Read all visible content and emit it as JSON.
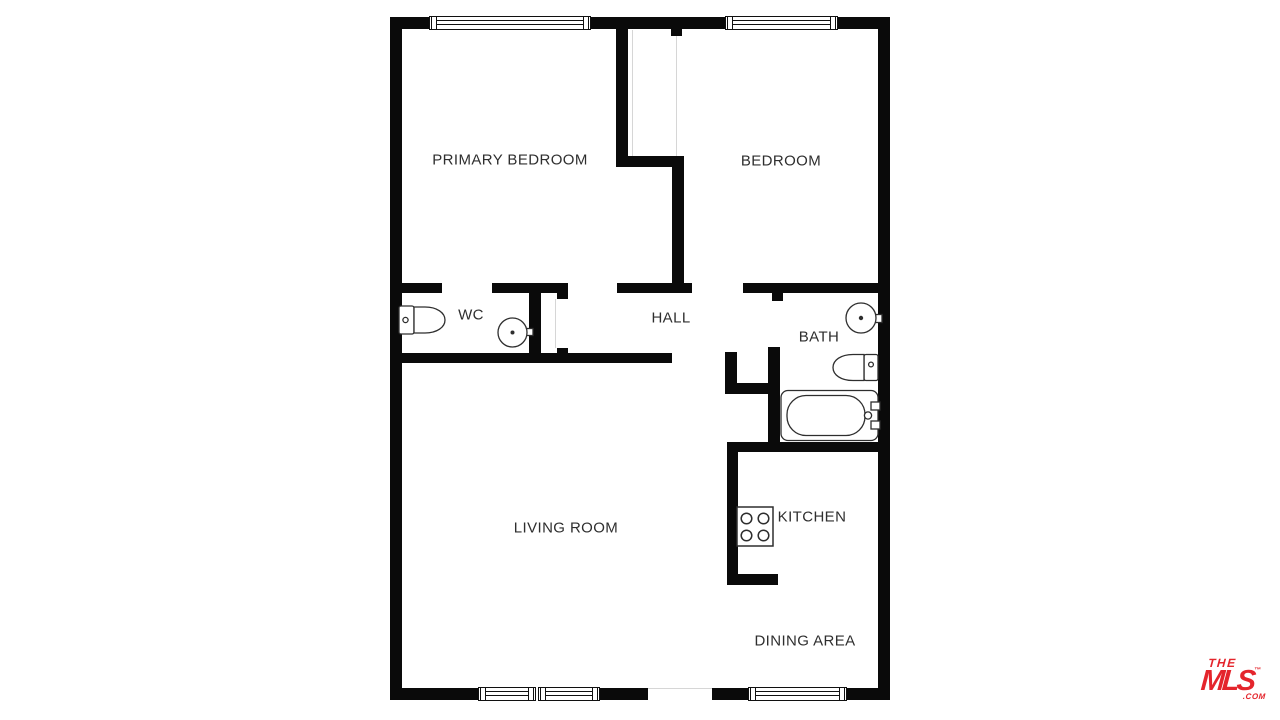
{
  "floorplan": {
    "wall_color": "#0a0a0a",
    "rooms": [
      {
        "label": "PRIMARY BEDROOM"
      },
      {
        "label": "BEDROOM"
      },
      {
        "label": "WC"
      },
      {
        "label": "HALL"
      },
      {
        "label": "BATH"
      },
      {
        "label": "LIVING ROOM"
      },
      {
        "label": "KITCHEN"
      },
      {
        "label": "DINING AREA"
      }
    ],
    "fixtures": [
      {
        "name": "toilet-icon",
        "room": "WC"
      },
      {
        "name": "sink-icon",
        "room": "WC"
      },
      {
        "name": "sink-icon",
        "room": "BATH"
      },
      {
        "name": "toilet-icon",
        "room": "BATH"
      },
      {
        "name": "bathtub-icon",
        "room": "BATH"
      },
      {
        "name": "stove-icon",
        "room": "KITCHEN"
      }
    ]
  },
  "branding": {
    "the": "THE",
    "mls": "MLS",
    "trademark": "™",
    "com": ".COM",
    "color": "#e4252c"
  }
}
